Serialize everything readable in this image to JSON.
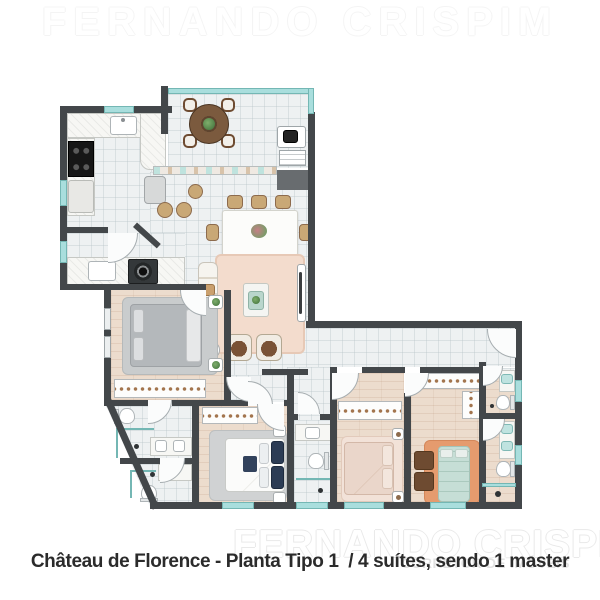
{
  "caption": "Château de Florence - Planta Tipo 1  / 4 suítes, sendo 1 master",
  "watermark": {
    "line1": "FERNANDO CRISPIM",
    "line2": "CORRETOR DE IMÓVEIS"
  },
  "rooms": [
    "gourmet-balcony",
    "kitchen",
    "laundry",
    "dining-room",
    "living-room",
    "hallway",
    "suite-1",
    "suite-2",
    "suite-3",
    "master-suite",
    "master-closet",
    "bathroom-1",
    "bathroom-2",
    "suite-2-bathroom",
    "suite-3-bathroom",
    "master-bathroom",
    "service-terrace"
  ],
  "colors": {
    "wall": "#43474a",
    "glass_teal": "#a9dedd",
    "floor_tile": "#eef1f2",
    "floor_wood": "#ecdccd",
    "rug_pink": "#f3dccd",
    "rug_orange": "#e59b6e",
    "bed_gray": "#b4b8bb",
    "bed_teal": "#c6ded6",
    "bed_beige": "#ead6ca",
    "navy": "#2c3c55",
    "chair_tan": "#c9a876",
    "furniture_brown": "#6e4b31",
    "caption_text": "#2b2b2b",
    "watermark_gray": "#e9e9e9"
  }
}
